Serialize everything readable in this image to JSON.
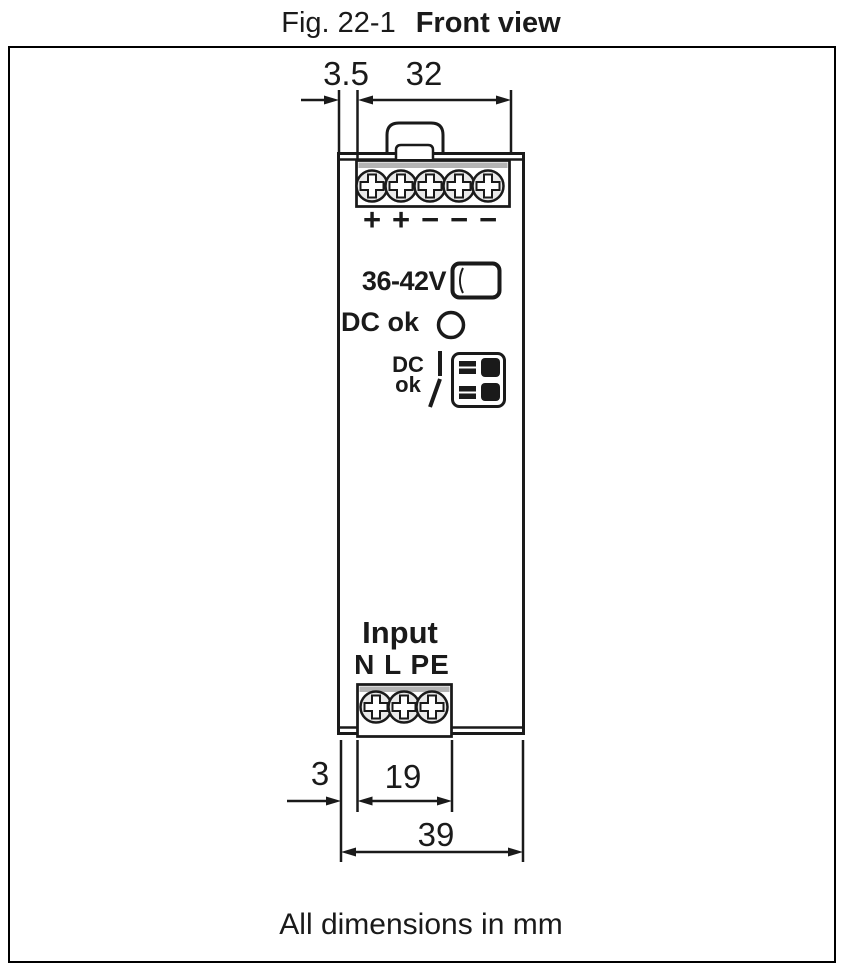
{
  "title": {
    "label": "Fig. 22-1",
    "name": "Front view"
  },
  "footer": {
    "note": "All dimensions in mm"
  },
  "front_panel": {
    "voltage_range": "36-42V",
    "dc_ok_led_label": "DC ok",
    "dc_ok_relay_label": [
      "DC",
      "ok"
    ],
    "input_label": "Input",
    "input_terminal_labels": "N L PE",
    "output_polarity": [
      "+",
      "+",
      "−",
      "−",
      "−"
    ]
  },
  "dimensions_mm": {
    "top_left_offset": "3.5",
    "top_terminal_width": "32",
    "bottom_left_offset": "3",
    "bottom_terminal_width": "19",
    "overall_width": "39"
  },
  "icons": {
    "screw": "phillips-screw-circle",
    "din_clip": "din-rail-clip-tab",
    "potentiometer": "voltage-adjust-slot",
    "dc_ok_led": "status-led-circle",
    "relay_contact": "normally-open-contact-symbol",
    "relay_terminal": "plug-terminal-block"
  },
  "colors": {
    "line": "#1a1a1a",
    "fill": "#ffffff",
    "terminal_strip_gray": "#b4b4b4",
    "screw_fill": "#e9e9e9",
    "dark_fill": "#1a1a1a"
  }
}
